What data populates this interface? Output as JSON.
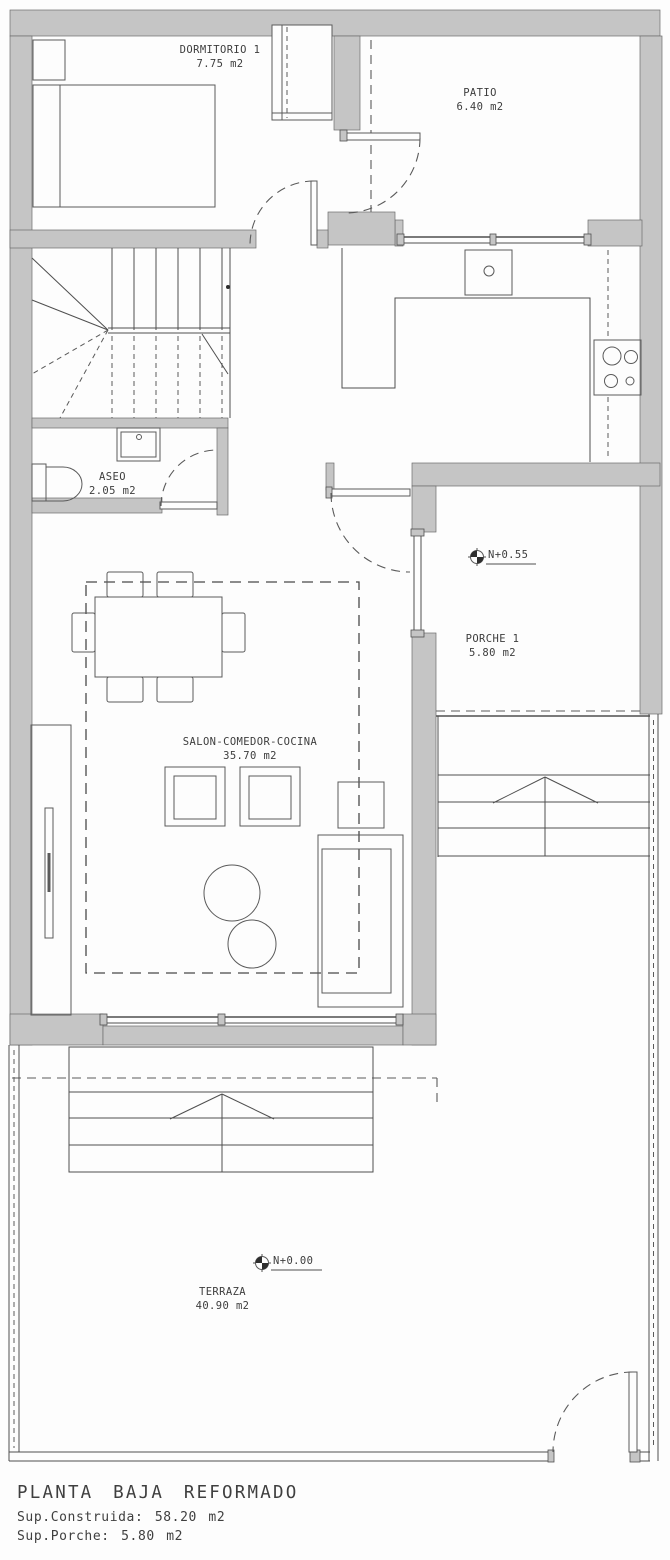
{
  "plan": {
    "rooms": {
      "dormitorio": {
        "name": "DORMITORIO 1",
        "area": "7.75 m2"
      },
      "patio": {
        "name": "PATIO",
        "area": "6.40 m2"
      },
      "aseo": {
        "name": "ASEO",
        "area": "2.05 m2"
      },
      "salon": {
        "name": "SALON-COMEDOR-COCINA",
        "area": "35.70 m2"
      },
      "porche": {
        "name": "PORCHE 1",
        "area": "5.80 m2"
      },
      "terraza": {
        "name": "TERRAZA",
        "area": "40.90 m2"
      }
    },
    "levels": {
      "porche": {
        "label": "N+0.55"
      },
      "terraza": {
        "label": "N+0.00"
      }
    },
    "title_block": {
      "title": "PLANTA BAJA REFORMADO",
      "built_area": "Sup.Construida: 58.20 m2",
      "porch_area": "Sup.Porche: 5.80 m2"
    },
    "colors": {
      "wall_fill": "#c5c5c5",
      "line": "#4f4f4f",
      "boundary_dash": "#979797",
      "background": "#fdfdfd",
      "text": "#3d3d3d"
    }
  }
}
